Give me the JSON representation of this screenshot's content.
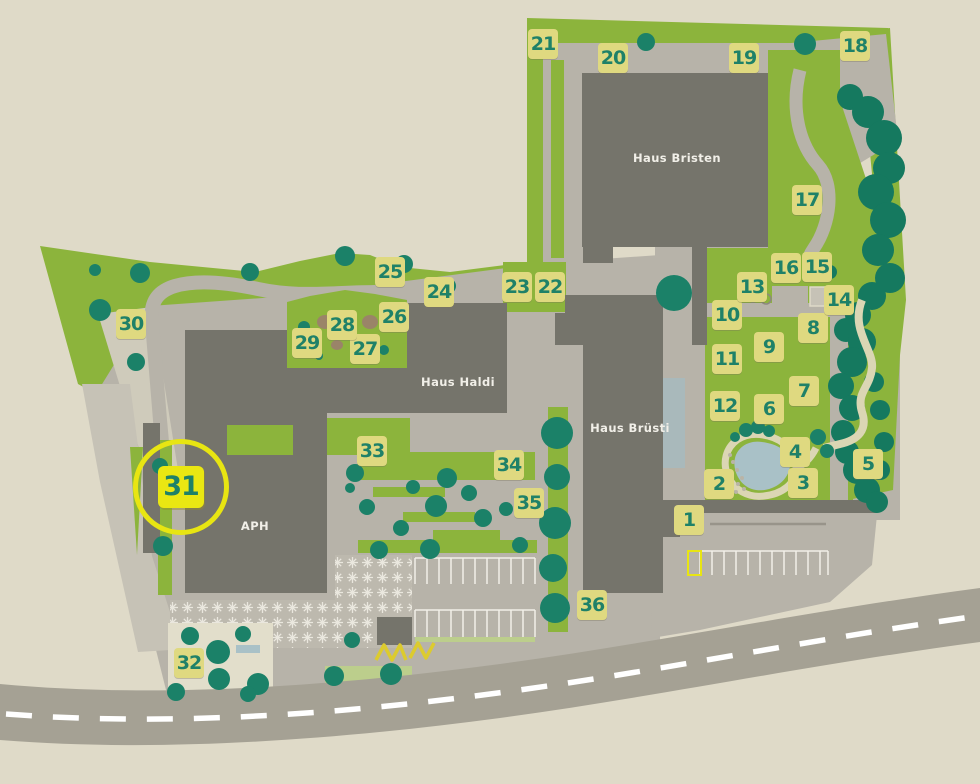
{
  "map": {
    "description": "Site plan with numbered garden / facility markers",
    "buildings": [
      {
        "id": "haus-bristen",
        "label": "Haus Bristen",
        "x": 677,
        "y": 158
      },
      {
        "id": "haus-haldi",
        "label": "Haus Haldi",
        "x": 458,
        "y": 382
      },
      {
        "id": "haus-bruesti",
        "label": "Haus Brüsti",
        "x": 630,
        "y": 428
      },
      {
        "id": "aph",
        "label": "APH",
        "x": 255,
        "y": 526
      }
    ],
    "markers": [
      {
        "n": "1",
        "x": 689,
        "y": 520
      },
      {
        "n": "2",
        "x": 719,
        "y": 484
      },
      {
        "n": "3",
        "x": 803,
        "y": 483
      },
      {
        "n": "4",
        "x": 795,
        "y": 452
      },
      {
        "n": "5",
        "x": 868,
        "y": 464
      },
      {
        "n": "6",
        "x": 769,
        "y": 409
      },
      {
        "n": "7",
        "x": 804,
        "y": 391
      },
      {
        "n": "8",
        "x": 813,
        "y": 328
      },
      {
        "n": "9",
        "x": 769,
        "y": 347
      },
      {
        "n": "10",
        "x": 727,
        "y": 315
      },
      {
        "n": "11",
        "x": 727,
        "y": 359
      },
      {
        "n": "12",
        "x": 725,
        "y": 406
      },
      {
        "n": "13",
        "x": 752,
        "y": 287
      },
      {
        "n": "14",
        "x": 839,
        "y": 300
      },
      {
        "n": "15",
        "x": 817,
        "y": 267
      },
      {
        "n": "16",
        "x": 786,
        "y": 268
      },
      {
        "n": "17",
        "x": 807,
        "y": 200
      },
      {
        "n": "18",
        "x": 855,
        "y": 46
      },
      {
        "n": "19",
        "x": 744,
        "y": 58
      },
      {
        "n": "20",
        "x": 613,
        "y": 58
      },
      {
        "n": "21",
        "x": 543,
        "y": 44
      },
      {
        "n": "22",
        "x": 550,
        "y": 287
      },
      {
        "n": "23",
        "x": 517,
        "y": 287
      },
      {
        "n": "24",
        "x": 439,
        "y": 292
      },
      {
        "n": "25",
        "x": 390,
        "y": 272
      },
      {
        "n": "26",
        "x": 394,
        "y": 317
      },
      {
        "n": "27",
        "x": 365,
        "y": 349
      },
      {
        "n": "28",
        "x": 342,
        "y": 325
      },
      {
        "n": "29",
        "x": 307,
        "y": 343
      },
      {
        "n": "30",
        "x": 131,
        "y": 324
      },
      {
        "n": "31",
        "x": 181,
        "y": 487,
        "highlighted": true
      },
      {
        "n": "32",
        "x": 189,
        "y": 663
      },
      {
        "n": "33",
        "x": 372,
        "y": 451
      },
      {
        "n": "34",
        "x": 509,
        "y": 465
      },
      {
        "n": "35",
        "x": 529,
        "y": 503
      },
      {
        "n": "36",
        "x": 592,
        "y": 605
      }
    ],
    "colors": {
      "background": "#DFDAC8",
      "grass": "#8CB43C",
      "pale_green": "#BCCE8C",
      "building": "#75746B",
      "path_gray": "#B7B3A9",
      "road": "#A5A194",
      "tree": "#1B8168",
      "forest": "#15795F",
      "pond": "#A9C1C7",
      "garden_path": "#DBD6B4",
      "badge_background": "#DFD980",
      "badge_text": "#1F8168",
      "highlight_yellow": "#E8E512",
      "road_marking": "#FFFFFF"
    }
  }
}
